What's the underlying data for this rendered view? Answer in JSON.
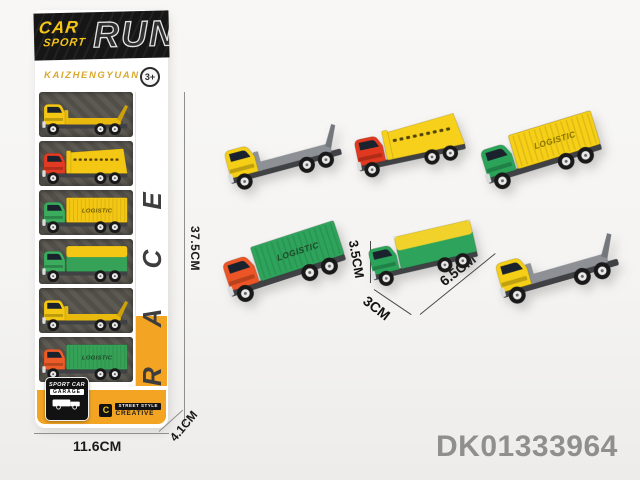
{
  "product_code": "DK01333964",
  "package": {
    "header": {
      "car": "CAR",
      "sport": "SPORT",
      "run": "RUN"
    },
    "brand": "KAIZHENGYUAN",
    "age_badge": "3+",
    "side_text": "RACE",
    "footer": {
      "garage_line1": "SPORT CAR",
      "garage_line2": "GARAGE",
      "logo_letter": "C",
      "street_style": "STREET STYLE",
      "creative": "CREATIVE"
    },
    "trucks": [
      {
        "name": "yellow-flatbed-truck",
        "type": "flatbed",
        "cab": "#f3c713",
        "bed": "#e9b90d",
        "ramp": "#cfa108",
        "label": ""
      },
      {
        "name": "red-dump-truck",
        "type": "dump",
        "cab": "#e23b23",
        "bed": "#f3c713",
        "label": ""
      },
      {
        "name": "green-truck-yellow-container",
        "type": "container",
        "cab": "#3bab5e",
        "bed": "#f3c713",
        "label": "LOGISTIC",
        "label_color": "#6b5800"
      },
      {
        "name": "green-truck-striped-container",
        "type": "covered",
        "cab": "#3bab5e",
        "bed": "#35a257",
        "bed2": "#f3c713",
        "label": ""
      },
      {
        "name": "yellow-flatbed-truck",
        "type": "flatbed",
        "cab": "#f3c713",
        "bed": "#e9b90d",
        "ramp": "#cfa108",
        "label": ""
      },
      {
        "name": "orange-truck-green-container",
        "type": "container",
        "cab": "#ec5b28",
        "bed": "#35a257",
        "label": "LOGISTIC",
        "label_color": "#1c4526"
      }
    ]
  },
  "dimension_labels": {
    "box_height": "37.5CM",
    "box_width": "11.6CM",
    "box_depth": "4.1CM",
    "truck_height": "3.5CM",
    "truck_width": "3CM",
    "truck_length": "6.5CM"
  },
  "loose_trucks": [
    {
      "name": "yellow-flatbed-truck",
      "type": "flatbed",
      "cab": "#f5ce16",
      "bed": "#8d9196",
      "ramp": "#74787d",
      "label": ""
    },
    {
      "name": "red-dump-truck",
      "type": "dump",
      "cab": "#e0391f",
      "bed": "#f6d01a",
      "label": ""
    },
    {
      "name": "green-truck-yellow-container",
      "type": "container",
      "cab": "#2ba45a",
      "bed": "#f6cf17",
      "label": "LOGISTIC",
      "label_color": "#857000"
    },
    {
      "name": "orange-truck-green-container",
      "type": "container",
      "cab": "#ee5526",
      "bed": "#2ea35b",
      "label": "LOGISTIC",
      "label_color": "#1c4526"
    },
    {
      "name": "green-covered-truck",
      "type": "covered",
      "cab": "#2ba45a",
      "bed": "#2ea35b",
      "bed2": "#f0d22b",
      "label": ""
    },
    {
      "name": "yellow-flatbed-truck",
      "type": "flatbed",
      "cab": "#f5ce16",
      "bed": "#8d9196",
      "ramp": "#74787d",
      "label": ""
    }
  ]
}
